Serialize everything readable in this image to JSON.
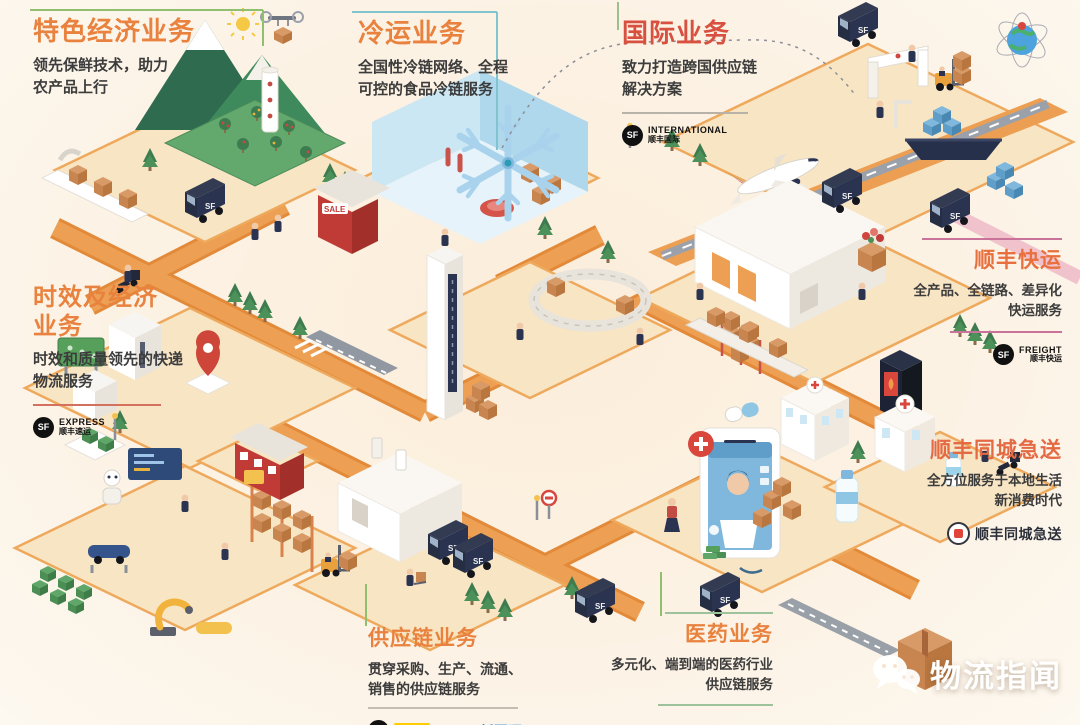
{
  "sections": {
    "special_economy": {
      "title": "特色经济业务",
      "desc": "领先保鲜技术，助力\n农产品上行"
    },
    "cold_chain": {
      "title": "冷运业务",
      "desc": "全国性冷链网络、全程\n可控的食品冷链服务"
    },
    "international": {
      "title": "国际业务",
      "desc": "致力打造跨国供应链\n解决方案",
      "logo": {
        "mark": "SF",
        "line1": "INTERNATIONAL",
        "line2": "顺丰国际"
      }
    },
    "express_economy": {
      "title": "时效及经济\n业务",
      "desc": "时效和质量领先的快递\n物流服务",
      "logo": {
        "mark": "SF",
        "line1": "EXPRESS",
        "line2": "顺丰速运"
      }
    },
    "freight": {
      "title": "顺丰快运",
      "desc": "全产品、全链路、差异化\n快运服务",
      "logo": {
        "mark": "SF",
        "line1": "FREIGHT",
        "line2": "顺丰快运"
      }
    },
    "intracity": {
      "title": "顺丰同城急送",
      "desc": "全方位服务于本地生活\n新消费时代",
      "logo_text": "顺丰同城急送"
    },
    "supply_chain": {
      "title": "供应链业务",
      "desc": "贯穿采购、生产、流通、\n销售的供应链服务",
      "logos": {
        "mark": "SF",
        "chip": "-DHL-",
        "partner": "新夏晖"
      }
    },
    "pharma": {
      "title": "医药业务",
      "desc": "多元化、端到端的医药行业\n供应链服务"
    }
  },
  "watermark": {
    "text": "物流指闻"
  },
  "colors": {
    "title_orange": "#E8823E",
    "title_red": "#D8503F",
    "title_warm": "#E46A44",
    "road": "#EDA053",
    "platform": "#F8E5C4",
    "green_line": "#8FBF6F",
    "teal_line": "#7FC4CF",
    "pink_line": "#C9729A"
  }
}
